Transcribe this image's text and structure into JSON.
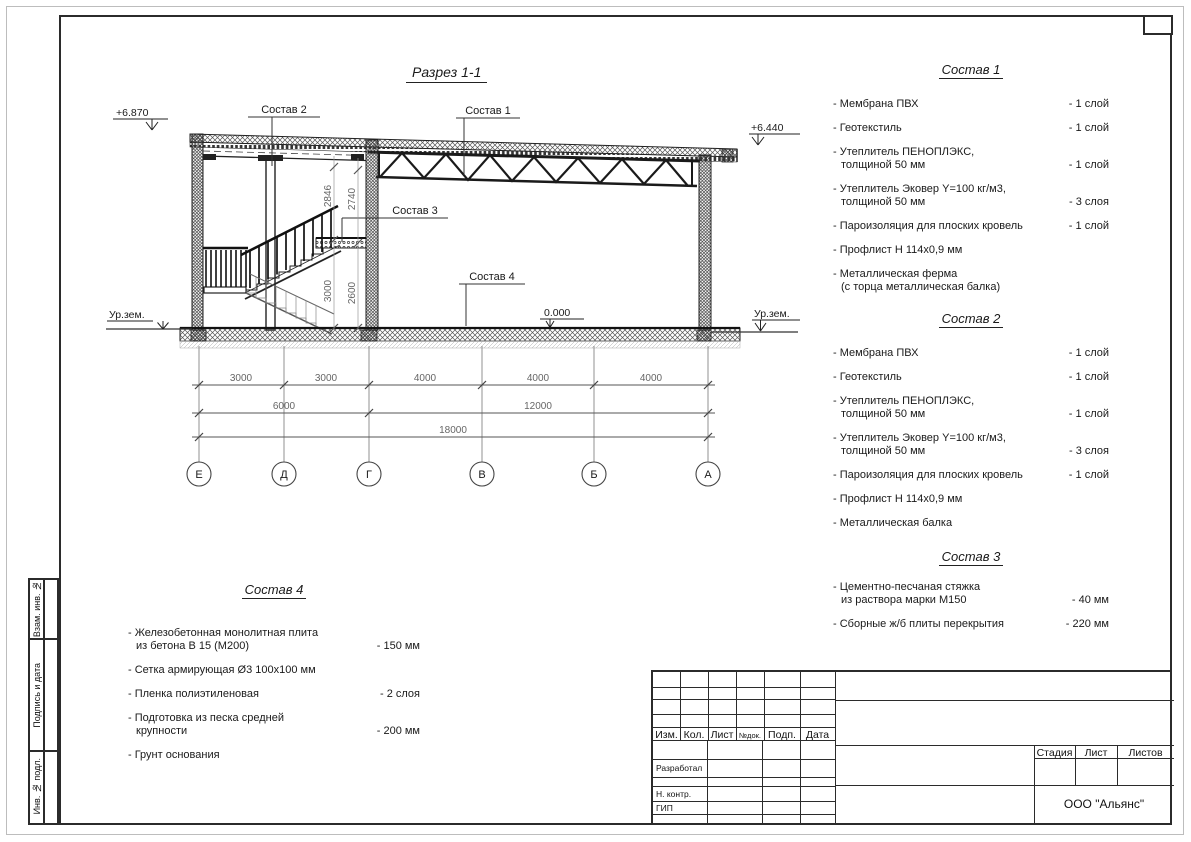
{
  "sheet": {
    "drawing_title": "Разрез 1-1"
  },
  "drawing": {
    "elev_left": "+6.870",
    "elev_right": "+6.440",
    "elev_zero": "0.000",
    "ground_left": "Ур.зем.",
    "ground_right": "Ур.зем.",
    "callout_1": "Состав 1",
    "callout_2": "Состав 2",
    "callout_3": "Состав 3",
    "callout_4": "Состав 4",
    "vdims": [
      "2846",
      "2740",
      "3000",
      "2600"
    ],
    "hdims1": [
      "3000",
      "3000",
      "4000",
      "4000",
      "4000"
    ],
    "hdims2": [
      "6000",
      "12000"
    ],
    "hdims3": [
      "18000"
    ],
    "axes": [
      "Е",
      "Д",
      "Г",
      "В",
      "Б",
      "А"
    ]
  },
  "compositions": [
    {
      "title": "Состав 1",
      "items": [
        {
          "name": "- Мембрана ПВХ",
          "value": "- 1 слой"
        },
        {
          "name": "- Геотекстиль",
          "value": "- 1 слой"
        },
        {
          "name": "- Утеплитель ПЕНОПЛЭКС,\nтолщиной 50 мм",
          "value": "- 1 слой"
        },
        {
          "name": "- Утеплитель Эковер Y=100 кг/м3,\nтолщиной 50 мм",
          "value": "- 3 слоя"
        },
        {
          "name": "- Пароизоляция для плоских кровель",
          "value": "- 1 слой"
        },
        {
          "name": "- Профлист Н 114х0,9 мм",
          "value": ""
        },
        {
          "name": "- Металлическая ферма\n(с торца металлическая балка)",
          "value": ""
        }
      ]
    },
    {
      "title": "Состав 2",
      "items": [
        {
          "name": "- Мембрана ПВХ",
          "value": "- 1 слой"
        },
        {
          "name": "- Геотекстиль",
          "value": "- 1 слой"
        },
        {
          "name": "- Утеплитель ПЕНОПЛЭКС,\nтолщиной 50 мм",
          "value": "- 1 слой"
        },
        {
          "name": "- Утеплитель Эковер Y=100 кг/м3,\nтолщиной 50 мм",
          "value": "- 3 слоя"
        },
        {
          "name": "- Пароизоляция для плоских кровель",
          "value": "- 1 слой"
        },
        {
          "name": "- Профлист Н 114х0,9 мм",
          "value": ""
        },
        {
          "name": "- Металлическая балка",
          "value": ""
        }
      ]
    },
    {
      "title": "Состав 3",
      "items": [
        {
          "name": "- Цементно-песчаная стяжка\nиз раствора марки М150",
          "value": "- 40 мм"
        },
        {
          "name": "- Сборные ж/б плиты перекрытия",
          "value": "- 220 мм"
        }
      ]
    },
    {
      "title": "Состав 4",
      "items": [
        {
          "name": "- Железобетонная  монолитная плита\nиз бетона В 15 (М200)",
          "value": "- 150 мм"
        },
        {
          "name": "- Сетка армирующая Ø3 100х100 мм",
          "value": ""
        },
        {
          "name": "- Пленка полиэтиленовая",
          "value": "- 2 слоя"
        },
        {
          "name": "- Подготовка из песка средней\nкрупности",
          "value": "- 200 мм"
        },
        {
          "name": "- Грунт основания",
          "value": ""
        }
      ]
    }
  ],
  "stamps_left": [
    "Взам. инв. №",
    "Подпись и дата",
    "Инв. № подл."
  ],
  "titleblock": {
    "cols": [
      "Изм.",
      "Кол.",
      "Лист",
      "№док.",
      "Подп.",
      "Дата"
    ],
    "roles": [
      "Разработал",
      "Н. контр.",
      "ГИП"
    ],
    "stage_cols": [
      "Стадия",
      "Лист",
      "Листов"
    ],
    "company": "ООО \"Альянс\""
  }
}
